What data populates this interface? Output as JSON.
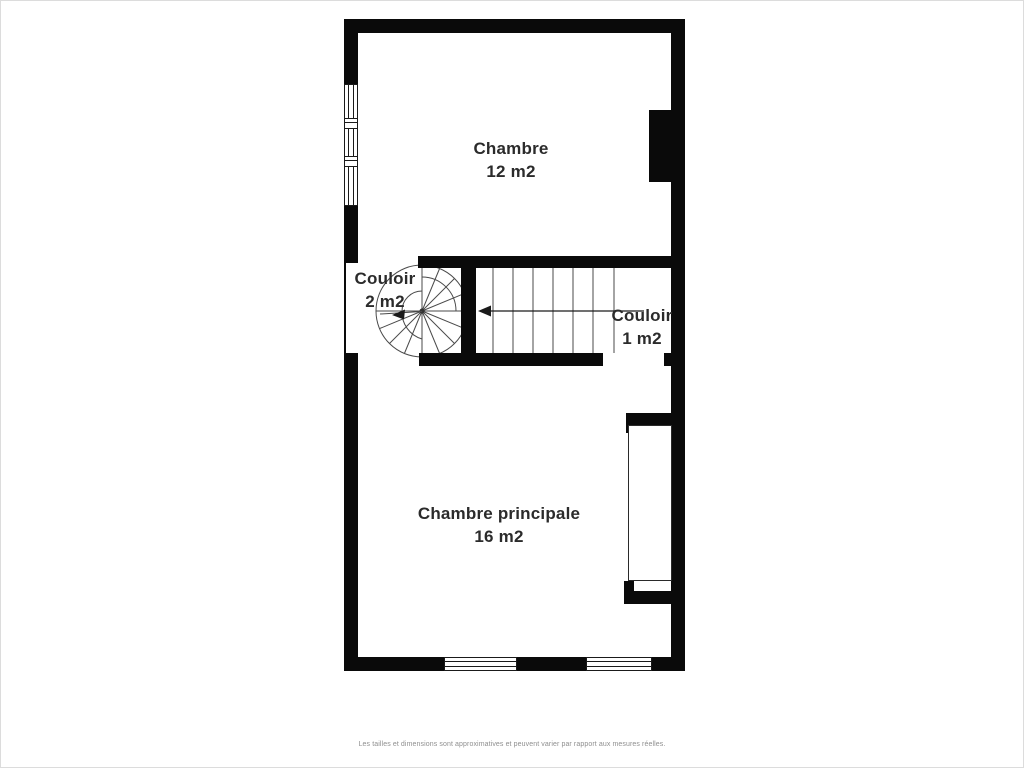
{
  "floorplan": {
    "rooms": [
      {
        "name": "Chambre",
        "area": "12 m2"
      },
      {
        "name": "Couloir",
        "area": "2 m2"
      },
      {
        "name": "Couloir",
        "area": "1 m2"
      },
      {
        "name": "Chambre principale",
        "area": "16 m2"
      }
    ],
    "disclaimer": "Les tailles et dimensions sont approximatives et peuvent varier par rapport aux mesures réelles.",
    "colors": {
      "wall": "#0a0a0a",
      "label_text": "#2b2b2b",
      "stair_line": "#4a4a4a",
      "disclaimer_text": "#8f8f8f",
      "background": "#ffffff"
    }
  }
}
